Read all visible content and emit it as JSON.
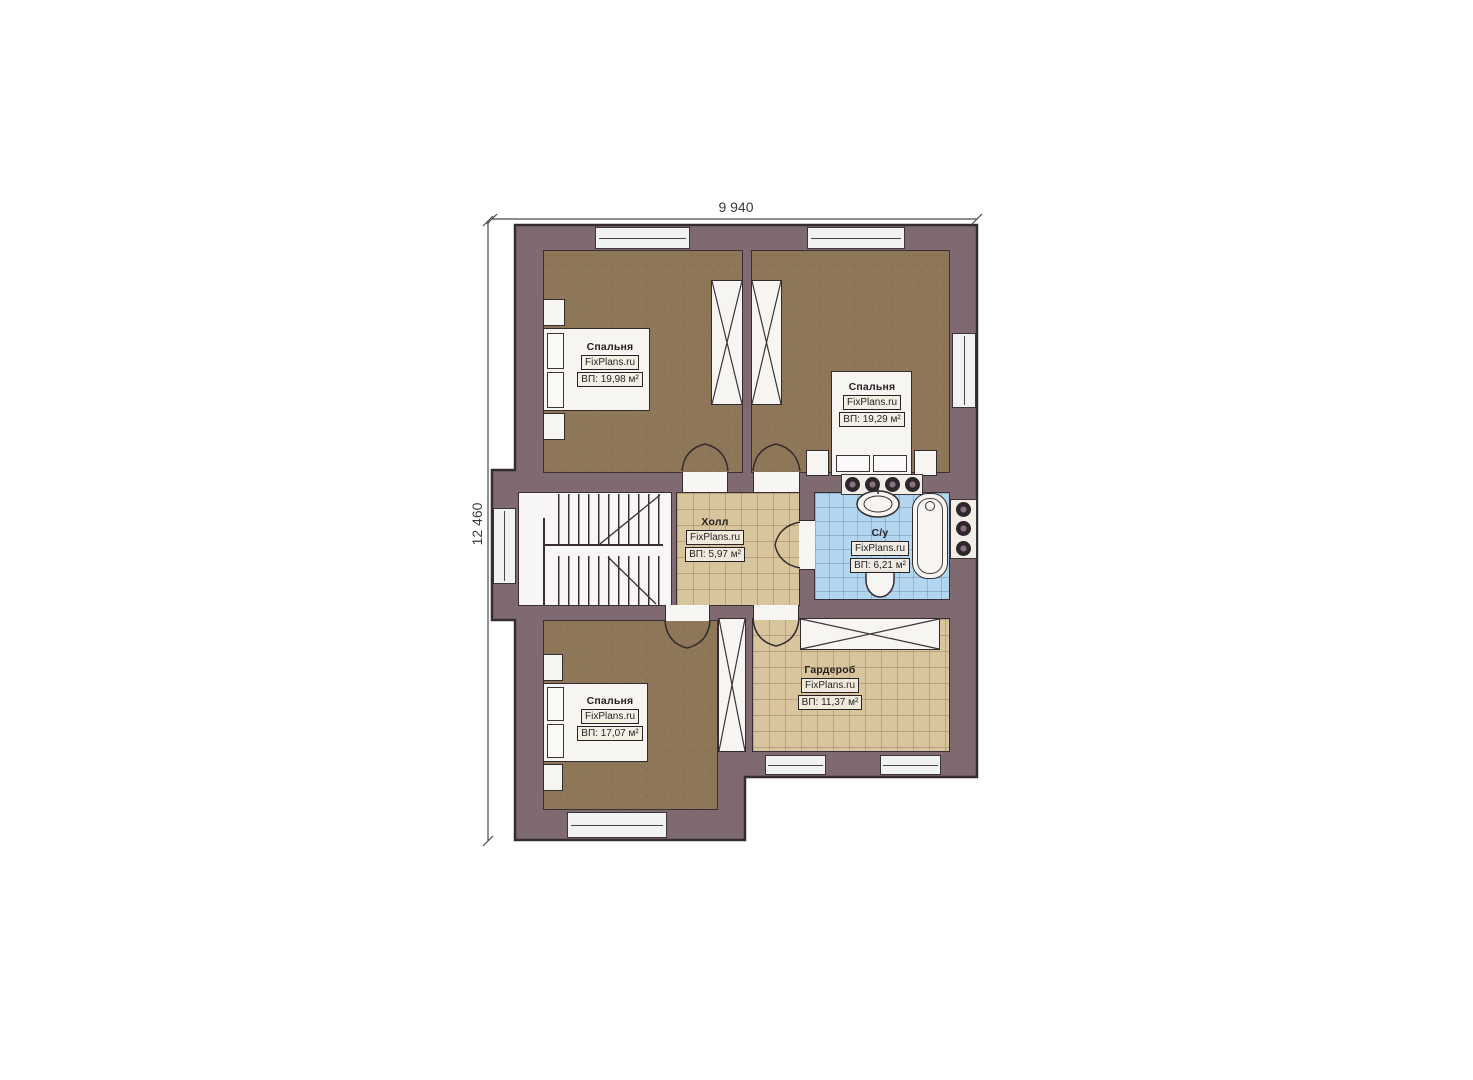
{
  "plan_title": "Floor plan (second storey)",
  "dimensions": {
    "top": "9 940",
    "left": "12 460"
  },
  "watermark": "FixPlans.ru",
  "rooms": {
    "bedroom_top_left": {
      "name": "Спальня",
      "area": "ВП: 19,98 м²"
    },
    "bedroom_top_right": {
      "name": "Спальня",
      "area": "ВП: 19,29 м²"
    },
    "hall": {
      "name": "Холл",
      "area": "ВП: 5,97 м²"
    },
    "bathroom": {
      "name": "С/у",
      "area": "ВП: 6,21 м²"
    },
    "bedroom_bottom": {
      "name": "Спальня",
      "area": "ВП: 17,07 м²"
    },
    "wardrobe_room": {
      "name": "Гардероб",
      "area": "ВП: 11,37 м²"
    }
  },
  "colors": {
    "wall": "#806a71",
    "outline": "#352c30",
    "wood_floor": "#8d7758",
    "tile_tan": "#d8c59e",
    "tile_blue": "#b2d6f0",
    "fixture_white": "#f7f5f2",
    "dimension_line": "#4a4a4a"
  }
}
